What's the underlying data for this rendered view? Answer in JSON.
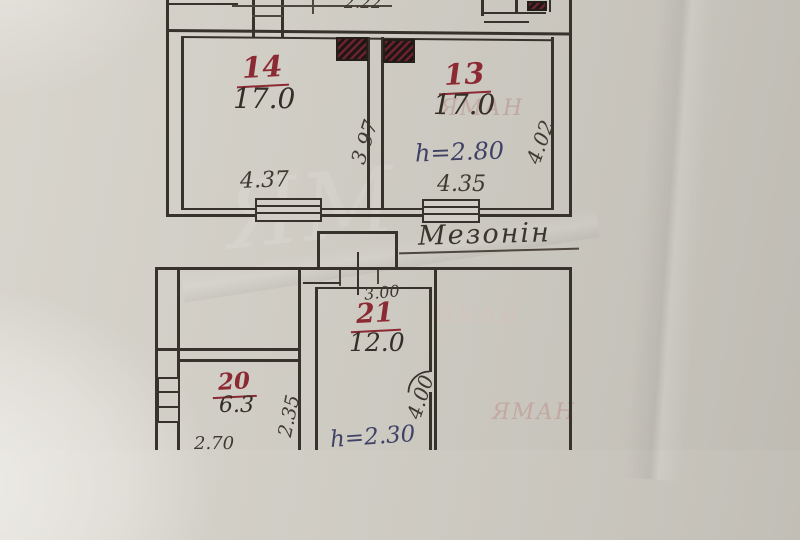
{
  "mezzanine": {
    "title": "Мезонін",
    "dim_top": "2.22",
    "room_14": {
      "number": "14",
      "area": "17.0",
      "width": "4.37",
      "depth": "3.97"
    },
    "room_13": {
      "number": "13",
      "area": "17.0",
      "width": "4.35",
      "depth": "4.02",
      "height_note": "h=2.80"
    }
  },
  "ground_floor": {
    "room_21": {
      "number": "21",
      "area": "12.0",
      "width": "3.00",
      "depth": "4.00",
      "height_note": "h=2.30"
    },
    "room_20": {
      "number": "20",
      "area": "6.3",
      "width": "2.70",
      "depth": "2.35"
    }
  },
  "watermark": {
    "text": "ЯМАН",
    "text_short": "ЯМ"
  }
}
